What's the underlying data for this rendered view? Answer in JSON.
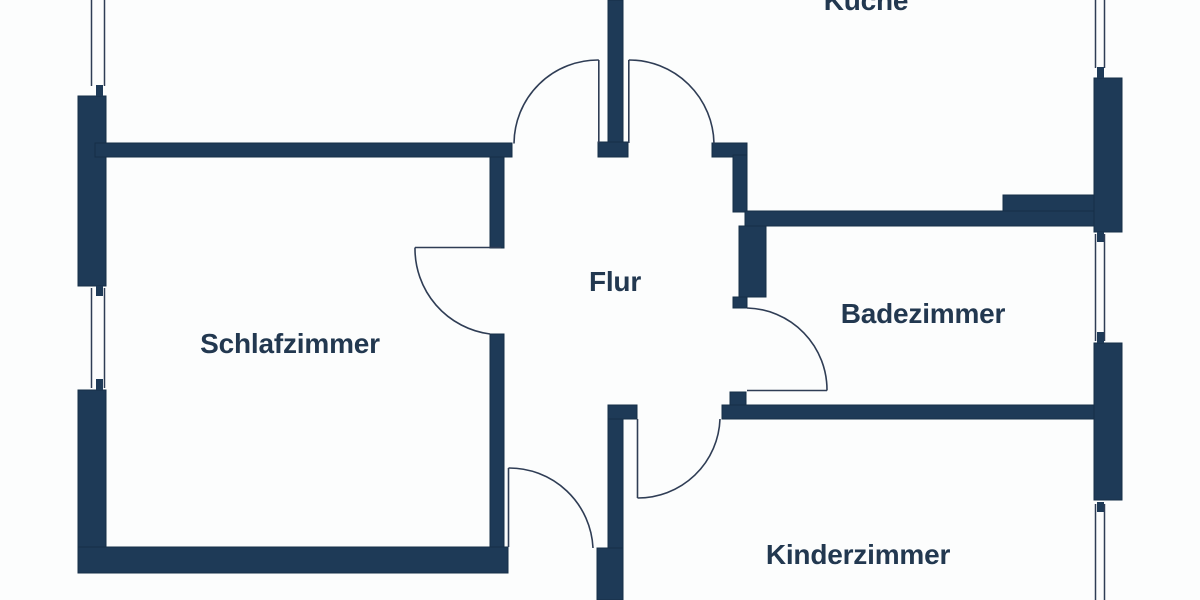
{
  "page": {
    "type": "apartment floor plan",
    "background": "#fcfdfd"
  },
  "colors": {
    "wall": "#1e3a57",
    "wall-edge": "#152e47",
    "line": "#2f3d55",
    "label": "#223850",
    "background": "#fcfdfd"
  },
  "rooms": [
    {
      "id": "schlafzimmer",
      "label": "Schlafzimmer"
    },
    {
      "id": "flur",
      "label": "Flur"
    },
    {
      "id": "kueche",
      "label": "Küche"
    },
    {
      "id": "badezimmer",
      "label": "Badezimmer"
    },
    {
      "id": "kinderzimmer",
      "label": "Kinderzimmer"
    }
  ]
}
